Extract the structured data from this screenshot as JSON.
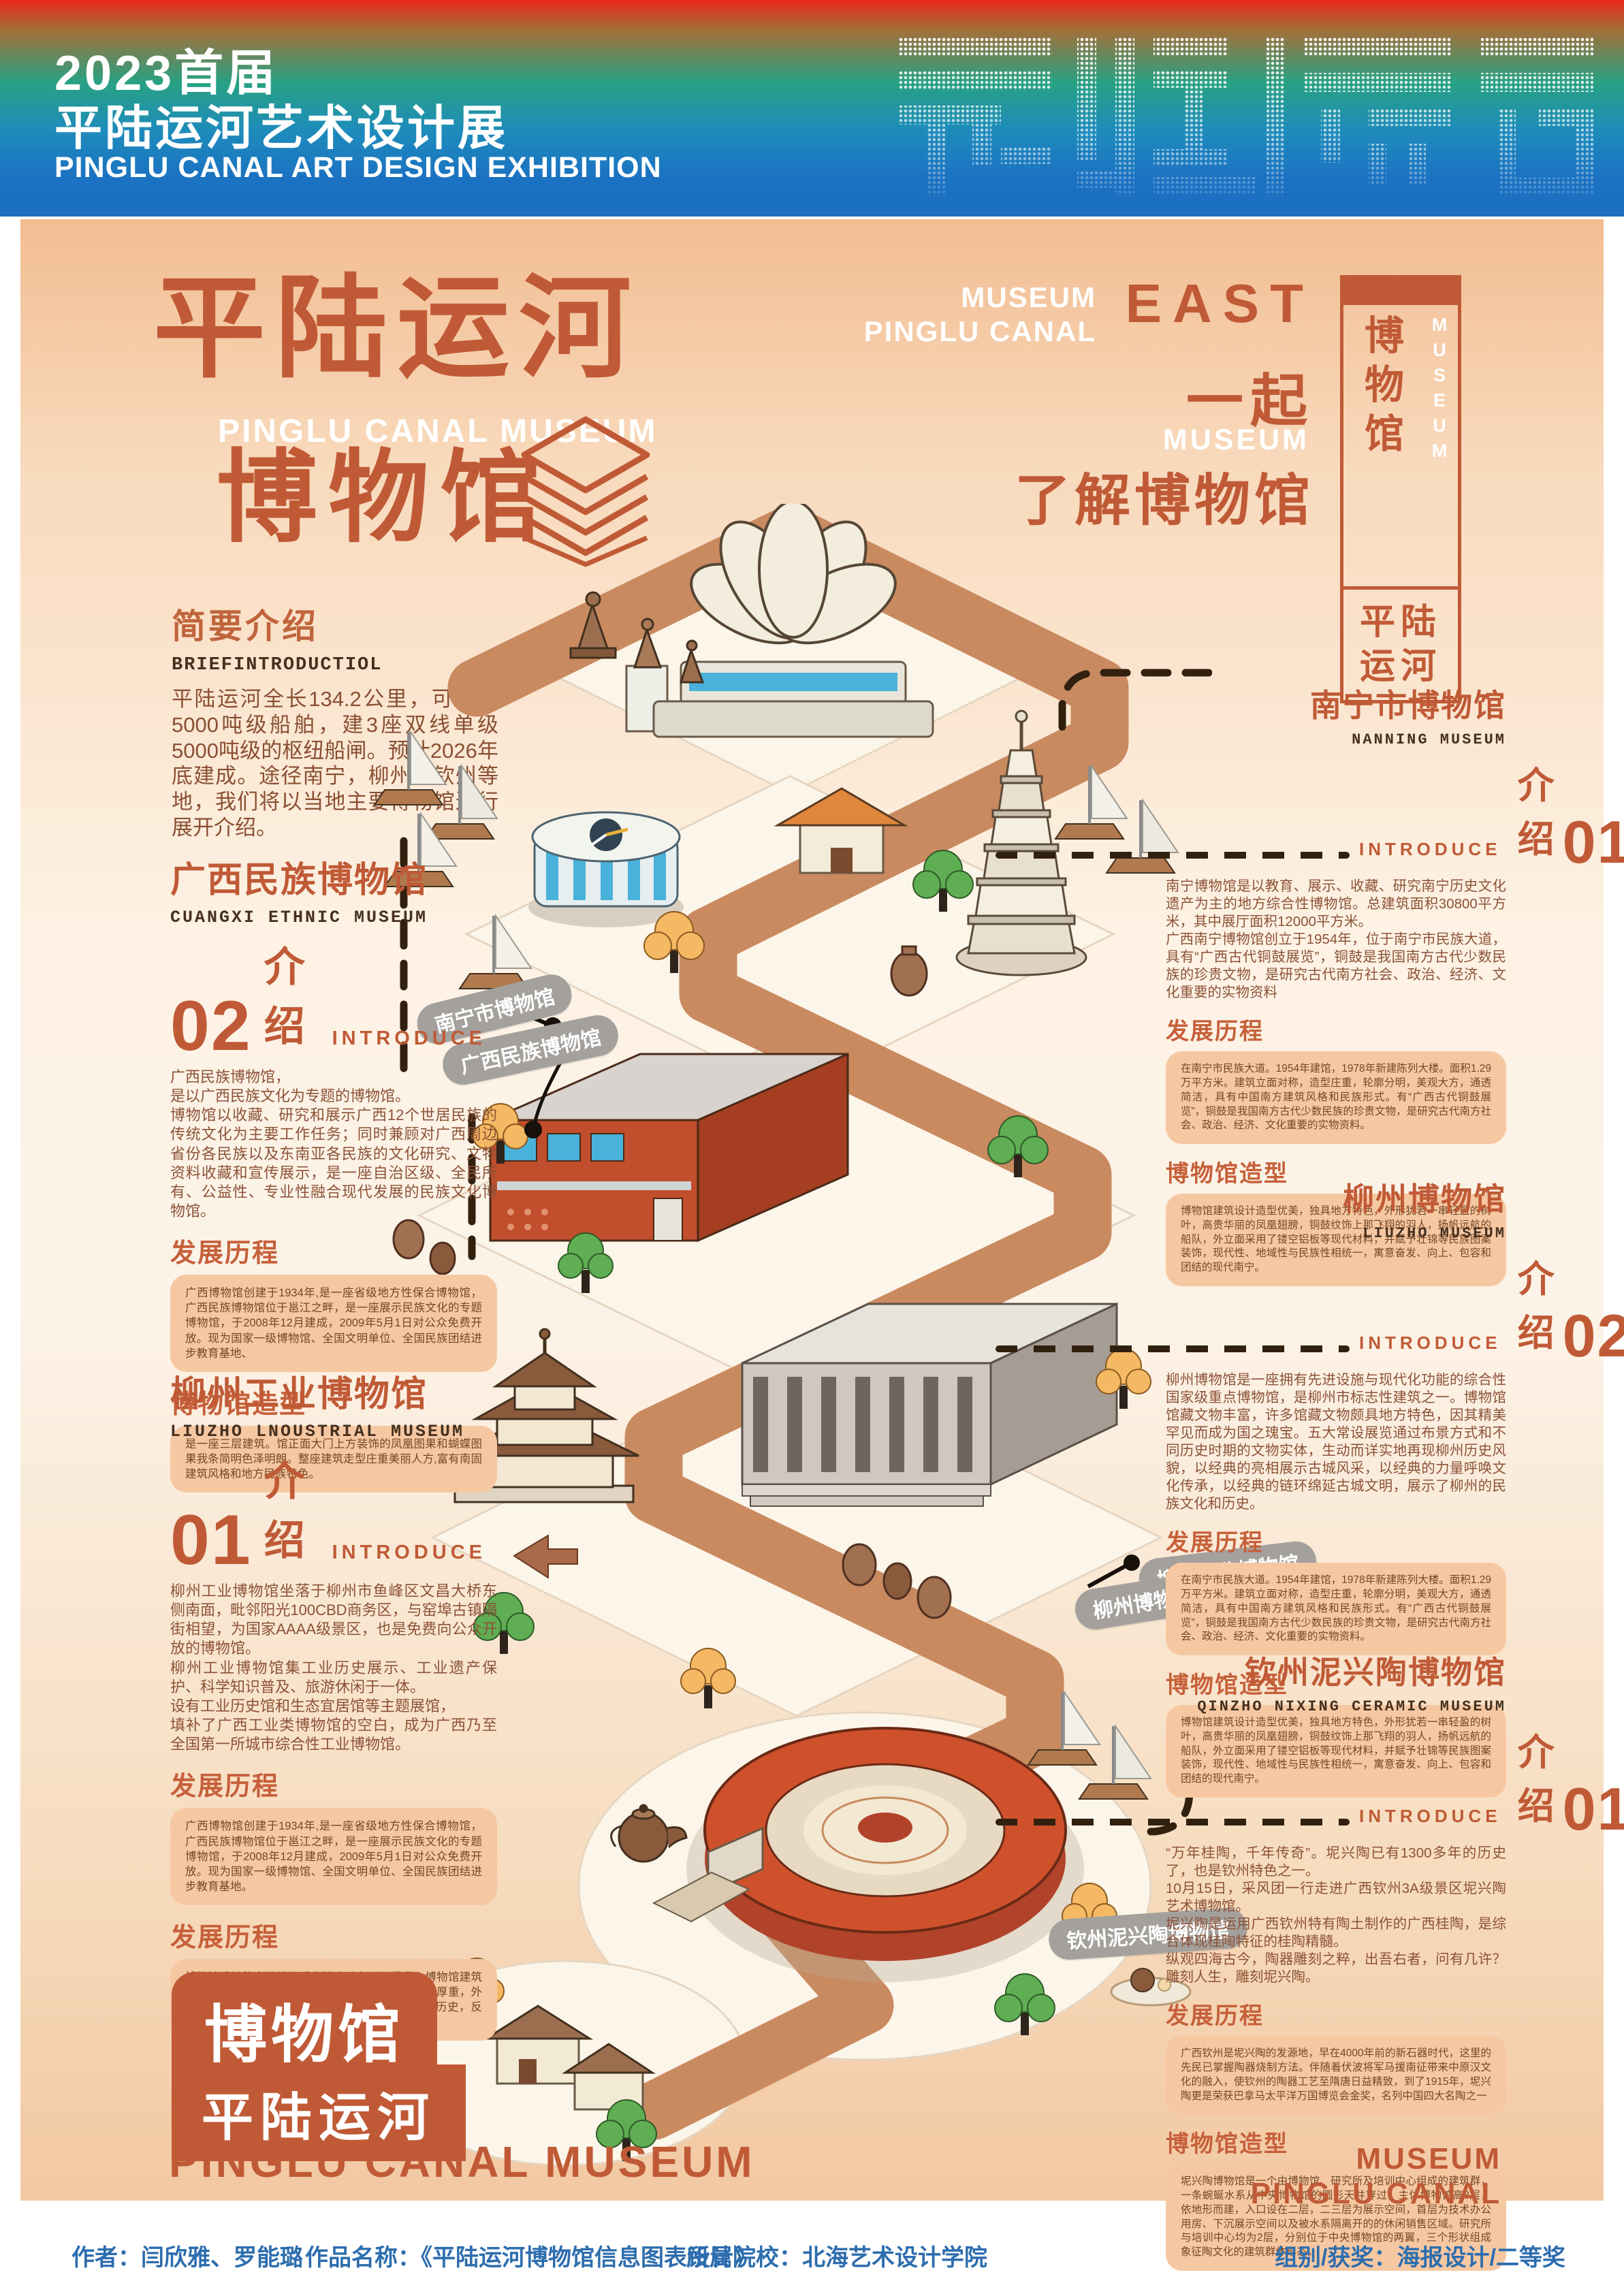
{
  "header": {
    "title_line1": "2023首届",
    "title_line2": "平陆运河艺术设计展",
    "subtitle": "PINGLU CANAL ART DESIGN EXHIBITION",
    "logo_icon": "pinglu-canal-halftone-logotype"
  },
  "hero": {
    "title_cn": "平陆运河",
    "title_en": "PINGLU CANAL MUSEUM",
    "title_cn2": "博物馆",
    "museum_line1": "MUSEUM",
    "museum_line2": "PINGLU CANAL",
    "east": "EAST",
    "together": "一起",
    "museum_small": "MUSEUM",
    "learn": "了解博物馆"
  },
  "side_banner": {
    "cn": "博物馆",
    "en": "MUSEUM",
    "canal": "平陆\n运河"
  },
  "brief": {
    "title": "简要介绍",
    "subtitle": "BRIEFINTRODUCTIOL",
    "body": "平陆运河全长134.2公里，可通航5000吨级船舶，建3座双线单级5000吨级的枢纽船闸。预计2026年底建成。途径南宁，柳州，钦州等地，我们将以当地主要博物馆进行展开介绍。"
  },
  "sections": {
    "guangxi": {
      "title": "广西民族博物馆",
      "subtitle": "CUANGXI ETHNIC MUSEUM",
      "number": "02",
      "intro_cn": "介绍",
      "intro_en": "INTRODUCE",
      "body": "广西民族博物馆，\n是以广西民族文化为专题的博物馆。\n博物馆以收藏、研究和展示广西12个世居民族的传统文化为主要工作任务；同时兼顾对广西周边省份各民族以及东南亚各民族的文化研究、文物资料收藏和宣传展示，是一座自治区级、全民所有、公益性、专业性融合现代发展的民族文化博物馆。",
      "blocks": [
        {
          "heading": "发展历程",
          "text": "广西博物馆创建于1934年,是一座省级地方性保合博物馆，广西民族博物馆位于邕江之畔，是一座展示民族文化的专题博物馆，于2008年12月建成，2009年5月1日对公众免费开放。现为国家一级博物馆、全国文明单位、全国民族团结进步教育基地、"
        },
        {
          "heading": "博物馆造型",
          "text": "是一座三层建筑。馆正面大门上方装饰的凤凰图果和蝴蝶图果我条简明色泽明朗。整座建筑走型庄重美丽人方,富有南固建筑风格和地方民族特色。"
        }
      ]
    },
    "liuzhou_industrial": {
      "title": "柳州工业博物馆",
      "subtitle": "LIUZHO LNOUSTRIAL MUSEUM",
      "number": "01",
      "intro_cn": "介绍",
      "intro_en": "INTRODUCE",
      "body": "柳州工业博物馆坐落于柳州市鱼峰区文昌大桥东侧南面，毗邻阳光100CBD商务区，与窑埠古镇隔街相望，为国家AAAA级景区，也是免费向公众开放的博物馆。\n柳州工业博物馆集工业历史展示、工业遗产保护、科学知识普及、旅游休闲于一体。\n设有工业历史馆和生态宜居馆等主题展馆，\n填补了广西工业类博物馆的空白，成为广西乃至全国第一所城市综合性工业博物馆。",
      "blocks": [
        {
          "heading": "发展历程",
          "text": "广西博物馆创建于1934年,是一座省级地方性保合博物馆，广西民族博物馆位于邕江之畔，是一座展示民族文化的专题博物馆，于2008年12月建成，2009年5月1日对公众免费开放。现为国家一级博物馆、全国文明单位、全国民族团结进步教育基地。"
        },
        {
          "heading": "发展历程",
          "text": "博物馆设计的空间纵深感和性冷淡色调深得我心博物馆建筑主体采用花岗岩风暴石砌筑，为古城阙样式，典雅厚重，外廊21面浮雕，寓意21世纪的柳州和2100年的厚重历史，反映柳州史前文明、民族民俗文化、现代文化等内容。"
        }
      ]
    },
    "nanning": {
      "title": "南宁市博物馆",
      "subtitle": "NANNING MUSEUM",
      "number": "01",
      "intro_cn": "介绍",
      "intro_en": "INTRODUCE",
      "body": "南宁博物馆是以教育、展示、收藏、研究南宁历史文化遗产为主的地方综合性博物馆。总建筑面积30800平方米，其中展厅面积12000平方米。\n广西南宁博物馆创立于1954年，位于南宁市民族大道，具有“广西古代铜鼓展览”，铜鼓是我国南方古代少数民族的珍贵文物，是研究古代南方社会、政治、经济、文化重要的实物资料",
      "blocks": [
        {
          "heading": "发展历程",
          "text": "在南宁市民族大道。1954年建馆，1978年新建陈列大楼。面积1.29万平方米。建筑立面对称，造型庄重，轮廓分明，美观大方，通透简洁，具有中国南方建筑风格和民族形式。有“广西古代铜鼓展览”，铜鼓是我国南方古代少数民族的珍贵文物，是研究古代南方社会、政治、经济、文化重要的实物资料。"
        },
        {
          "heading": "博物馆造型",
          "text": "博物馆建筑设计造型优美，独具地方特色，外形犹若一串轻盈的树叶，高贵华丽的凤凰翅膀，铜鼓纹饰上那飞翔的羽人，扬帆远航的船队，外立面采用了镂空铝板等现代材料，并赋予壮锦等民族图案装饰，现代性、地域性与民族性相统一，寓意奋发、向上、包容和团结的现代南宁。"
        }
      ]
    },
    "liuzhou": {
      "title": "柳州博物馆",
      "subtitle": "LIUZHO MUSEUM",
      "number": "02",
      "intro_cn": "介绍",
      "intro_en": "INTRODUCE",
      "body": "柳州博物馆是一座拥有先进设施与现代化功能的综合性国家级重点博物馆，是柳州市标志性建筑之一。博物馆馆藏文物丰富，许多馆藏文物颇具地方特色，因其精美罕见而成为国之瑰宝。五大常设展览通过布景方式和不同历史时期的文物实体，生动而详实地再现柳州历史风貌，以经典的亮相展示古城风采，以经典的力量呼唤文化传承，以经典的链环绵延古城文明，展示了柳州的民族文化和历史。",
      "blocks": [
        {
          "heading": "发展历程",
          "text": "在南宁市民族大道。1954年建馆，1978年新建陈列大楼。面积1.29万平方米。建筑立面对称，造型庄重，轮廓分明，美观大方，通透简洁，具有中国南方建筑风格和民族形式。有“广西古代铜鼓展览”，铜鼓是我国南方古代少数民族的珍贵文物，是研究古代南方社会、政治、经济、文化重要的实物资料。"
        },
        {
          "heading": "博物馆造型",
          "text": "博物馆建筑设计造型优美，独具地方特色，外形犹若一串轻盈的树叶，高贵华丽的凤凰翅膀，铜鼓纹饰上那飞翔的羽人，扬帆远航的船队，外立面采用了镂空铝板等现代材料，并赋予壮锦等民族图案装饰，现代性、地域性与民族性相统一，寓意奋发、向上、包容和团结的现代南宁。"
        }
      ]
    },
    "qinzhou": {
      "title": "钦州泥兴陶博物馆",
      "subtitle": "QINZHO NIXING CERAMIC MUSEUM",
      "number": "01",
      "intro_cn": "介绍",
      "intro_en": "INTRODUCE",
      "body": "“万年桂陶，千年传奇”。坭兴陶已有1300多年的历史了，也是钦州特色之一。\n10月15日，采风团一行走进广西钦州3A级景区坭兴陶艺术博物馆。\n坭兴陶是运用广西钦州特有陶土制作的广西桂陶，是综合体现桂陶特征的桂陶精髓。\n纵观四海古今，陶器雕刻之粹，出吾右者，问有几许？雕刻人生，雕刻坭兴陶。",
      "blocks": [
        {
          "heading": "发展历程",
          "text": "广西钦州是坭兴陶的发源地，早在4000年前的新石器时代，这里的先民已掌握陶器烧制方法。伴随着伏波将军马援南征带来中原汉文化的融入，使钦州的陶器工艺至隋唐日益精致，到了1915年，坭兴陶更是荣获巴拿马太平洋万国博览会金奖，名列中国四大名陶之一"
        },
        {
          "heading": "博物馆造型",
          "text": "坭兴陶博物馆是一个由博物馆、研究所及培训中心组成的建筑群，一条蜿蜒水系从中央博物馆的圆形天井穿过，主体博物馆高3层，依地形而建，入口设在二层，二三层为展示空间，首层为技术办公用房、下沉展示空间以及被水系隔离开的的休闲销售区域。研究所与培训中心均为2层，分别位于中央博物馆的两翼，三个形状组成象征陶文化的建筑群体形态。"
        }
      ]
    }
  },
  "map": {
    "labels": [
      "南宁市博物馆",
      "广西民族博物馆",
      "柳州工业博物馆",
      "柳州博物馆",
      "钦州泥兴陶博物馆"
    ]
  },
  "bottom_left": {
    "badge": "博物馆",
    "bar": "平陆运河",
    "en": "PINGLU CANAL MUSEUM"
  },
  "bottom_right": {
    "line1": "MUSEUM",
    "line2": "PINGLU CANAL"
  },
  "footer": {
    "items": [
      {
        "label": "作者：",
        "value": "闫欣雅、罗能璐"
      },
      {
        "label": "作品名称：",
        "value": "《平陆运河博物馆信息图表设计》"
      },
      {
        "label": "所属院校：",
        "value": "北海艺术设计学院"
      },
      {
        "label": "组别/获奖：",
        "value": "海报设计/二等奖"
      }
    ]
  }
}
